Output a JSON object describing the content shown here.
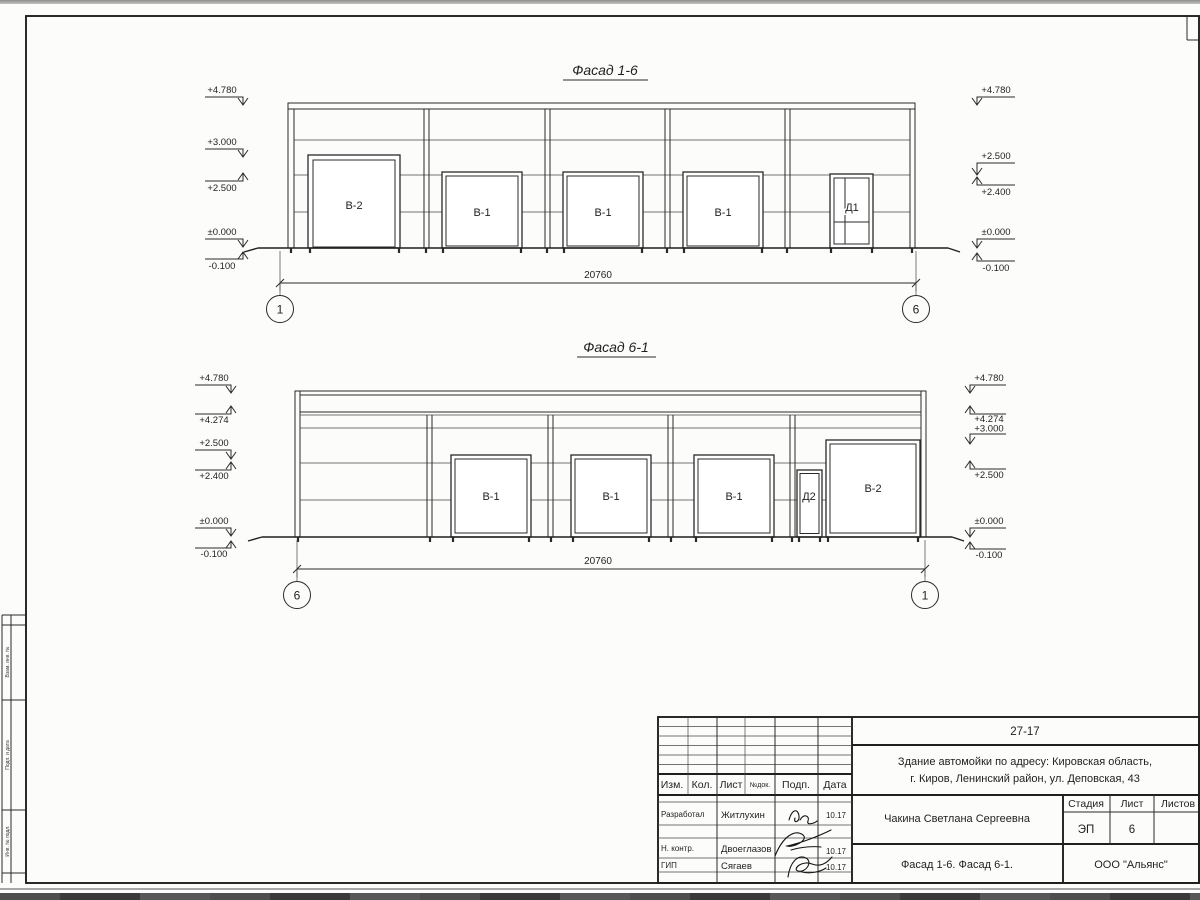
{
  "facade_top": {
    "title": "Фасад 1-6",
    "door_labels": [
      "В-2",
      "В-1",
      "В-1",
      "В-1",
      "Д1"
    ],
    "dimension": "20760",
    "axes": [
      "1",
      "6"
    ],
    "marks_left": [
      "+4.780",
      "+3.000",
      "+2.500",
      "±0.000",
      "-0.100"
    ],
    "marks_right": [
      "+4.780",
      "+2.500",
      "+2.400",
      "±0.000",
      "-0.100"
    ]
  },
  "facade_bottom": {
    "title": "Фасад 6-1",
    "door_labels": [
      "В-1",
      "В-1",
      "В-1",
      "Д2",
      "В-2"
    ],
    "dimension": "20760",
    "axes": [
      "6",
      "1"
    ],
    "marks_left": [
      "+4.780",
      "+4.274",
      "+2.500",
      "+2.400",
      "±0.000",
      "-0.100"
    ],
    "marks_right": [
      "+4.780",
      "+4.274",
      "+3.000",
      "+2.500",
      "±0.000",
      "-0.100"
    ]
  },
  "title_block": {
    "code": "27-17",
    "project_line1": "Здание автомойки по адресу: Кировская область,",
    "project_line2": "г. Киров, Ленинский район, ул. Деповская, 43",
    "col_izm": "Изм.",
    "col_kol": "Кол.",
    "col_list": "Лист",
    "col_doc": "№док.",
    "col_podp": "Подп.",
    "col_data": "Дата",
    "rows": [
      {
        "role": "Разработал",
        "name": "Житлухин",
        "date": "10.17"
      },
      {
        "role": "Н. контр.",
        "name": "Двоеглазов",
        "date": "10.17"
      },
      {
        "role": "ГИП",
        "name": "Сягаев",
        "date": "10.17"
      }
    ],
    "author": "Чакина Светлана Сергеевна",
    "stage_label": "Стадия",
    "sheet_label": "Лист",
    "sheets_label": "Листов",
    "stage": "ЭП",
    "sheet_number": "6",
    "sheet_title": "Фасад 1-6. Фасад 6-1.",
    "company": "ООО \"Альянс\""
  },
  "side_stamp": {
    "labels": [
      "Взам. инв. №",
      "Подп. и дата",
      "Инв. № подл."
    ]
  }
}
